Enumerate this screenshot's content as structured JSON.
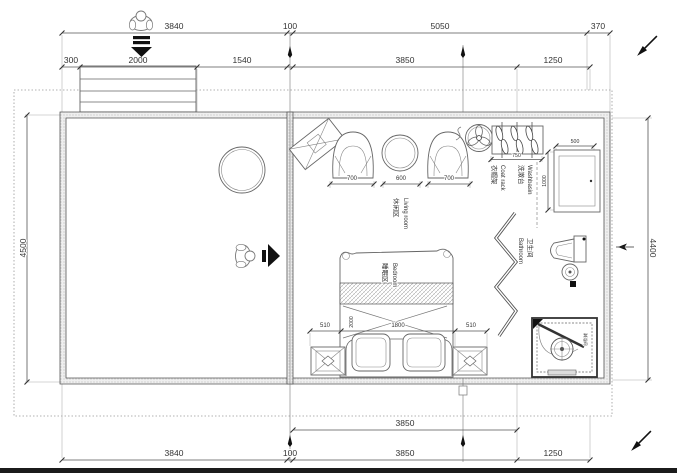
{
  "plan_type": "residential floor plan",
  "colors": {
    "line": "#4a4a4a",
    "wall_fill": "#efefef",
    "accent_black": "#111111",
    "boundary_dotted": "#999999",
    "text": "#333333",
    "background": "#ffffff"
  },
  "dimensions": {
    "top_row1": [
      "3840",
      "100",
      "5050",
      "370"
    ],
    "top_row2": [
      "300",
      "2000",
      "1540",
      "3850",
      "1250"
    ],
    "bottom_row1": [
      "3850"
    ],
    "bottom_row2": [
      "3840",
      "100",
      "3850",
      "1250"
    ],
    "left_side": "4500",
    "right_side": "4400",
    "living_row": [
      "700",
      "600",
      "700"
    ],
    "coat_rack_width": "750",
    "washbasin_width": "500",
    "washbasin_depth": "1000",
    "bed_row": [
      "510",
      "1800",
      "510"
    ],
    "bed_length": "2000"
  },
  "rooms": {
    "living": {
      "zh": "休闲区",
      "en": "Living room"
    },
    "coat_rack": {
      "zh": "衣帽架",
      "en": "Coat rack"
    },
    "washbasin": {
      "zh": "洗漱台",
      "en": "Washbasin"
    },
    "bathroom": {
      "zh": "卫生间",
      "en": "Bathroom"
    },
    "bedroom": {
      "zh": "睡眠区",
      "en": "Bedroom"
    },
    "shower": {
      "zh": "淋浴间",
      "en": ""
    }
  },
  "icons": {
    "entry_person": "person-top-view",
    "entry_arrow": "arrow-down",
    "room_person": "person-top-view",
    "room_arrow": "arrow-right",
    "fan": "ceiling-fan",
    "pen_top_right": "pen-mark",
    "pen_bottom_right": "pen-mark",
    "section_markers": "section-flag"
  }
}
